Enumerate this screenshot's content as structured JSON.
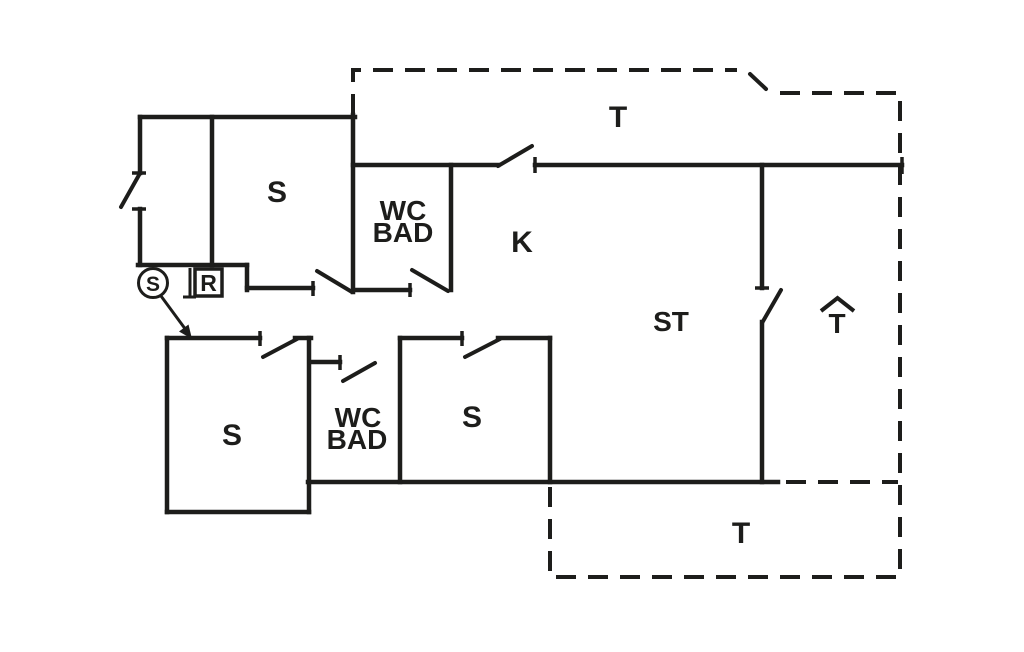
{
  "plan": {
    "type": "floor-plan",
    "colors": {
      "ink": "#1d1d1b",
      "background": "#ffffff"
    },
    "rooms": {
      "terrace_top": {
        "label": "T"
      },
      "terrace_bottom": {
        "label": "T"
      },
      "terrace_annex": {
        "label": "T"
      },
      "kitchen": {
        "label": "K"
      },
      "living_room": {
        "label": "ST"
      },
      "bedroom_upper": {
        "label": "S"
      },
      "bath_upper": {
        "line1": "WC",
        "line2": "BAD"
      },
      "bedroom_lower_left": {
        "label": "S"
      },
      "bath_lower": {
        "line1": "WC",
        "line2": "BAD"
      },
      "bedroom_lower_right": {
        "label": "S"
      }
    },
    "markers": {
      "circle_symbol": "S",
      "box_symbol": "R"
    }
  }
}
